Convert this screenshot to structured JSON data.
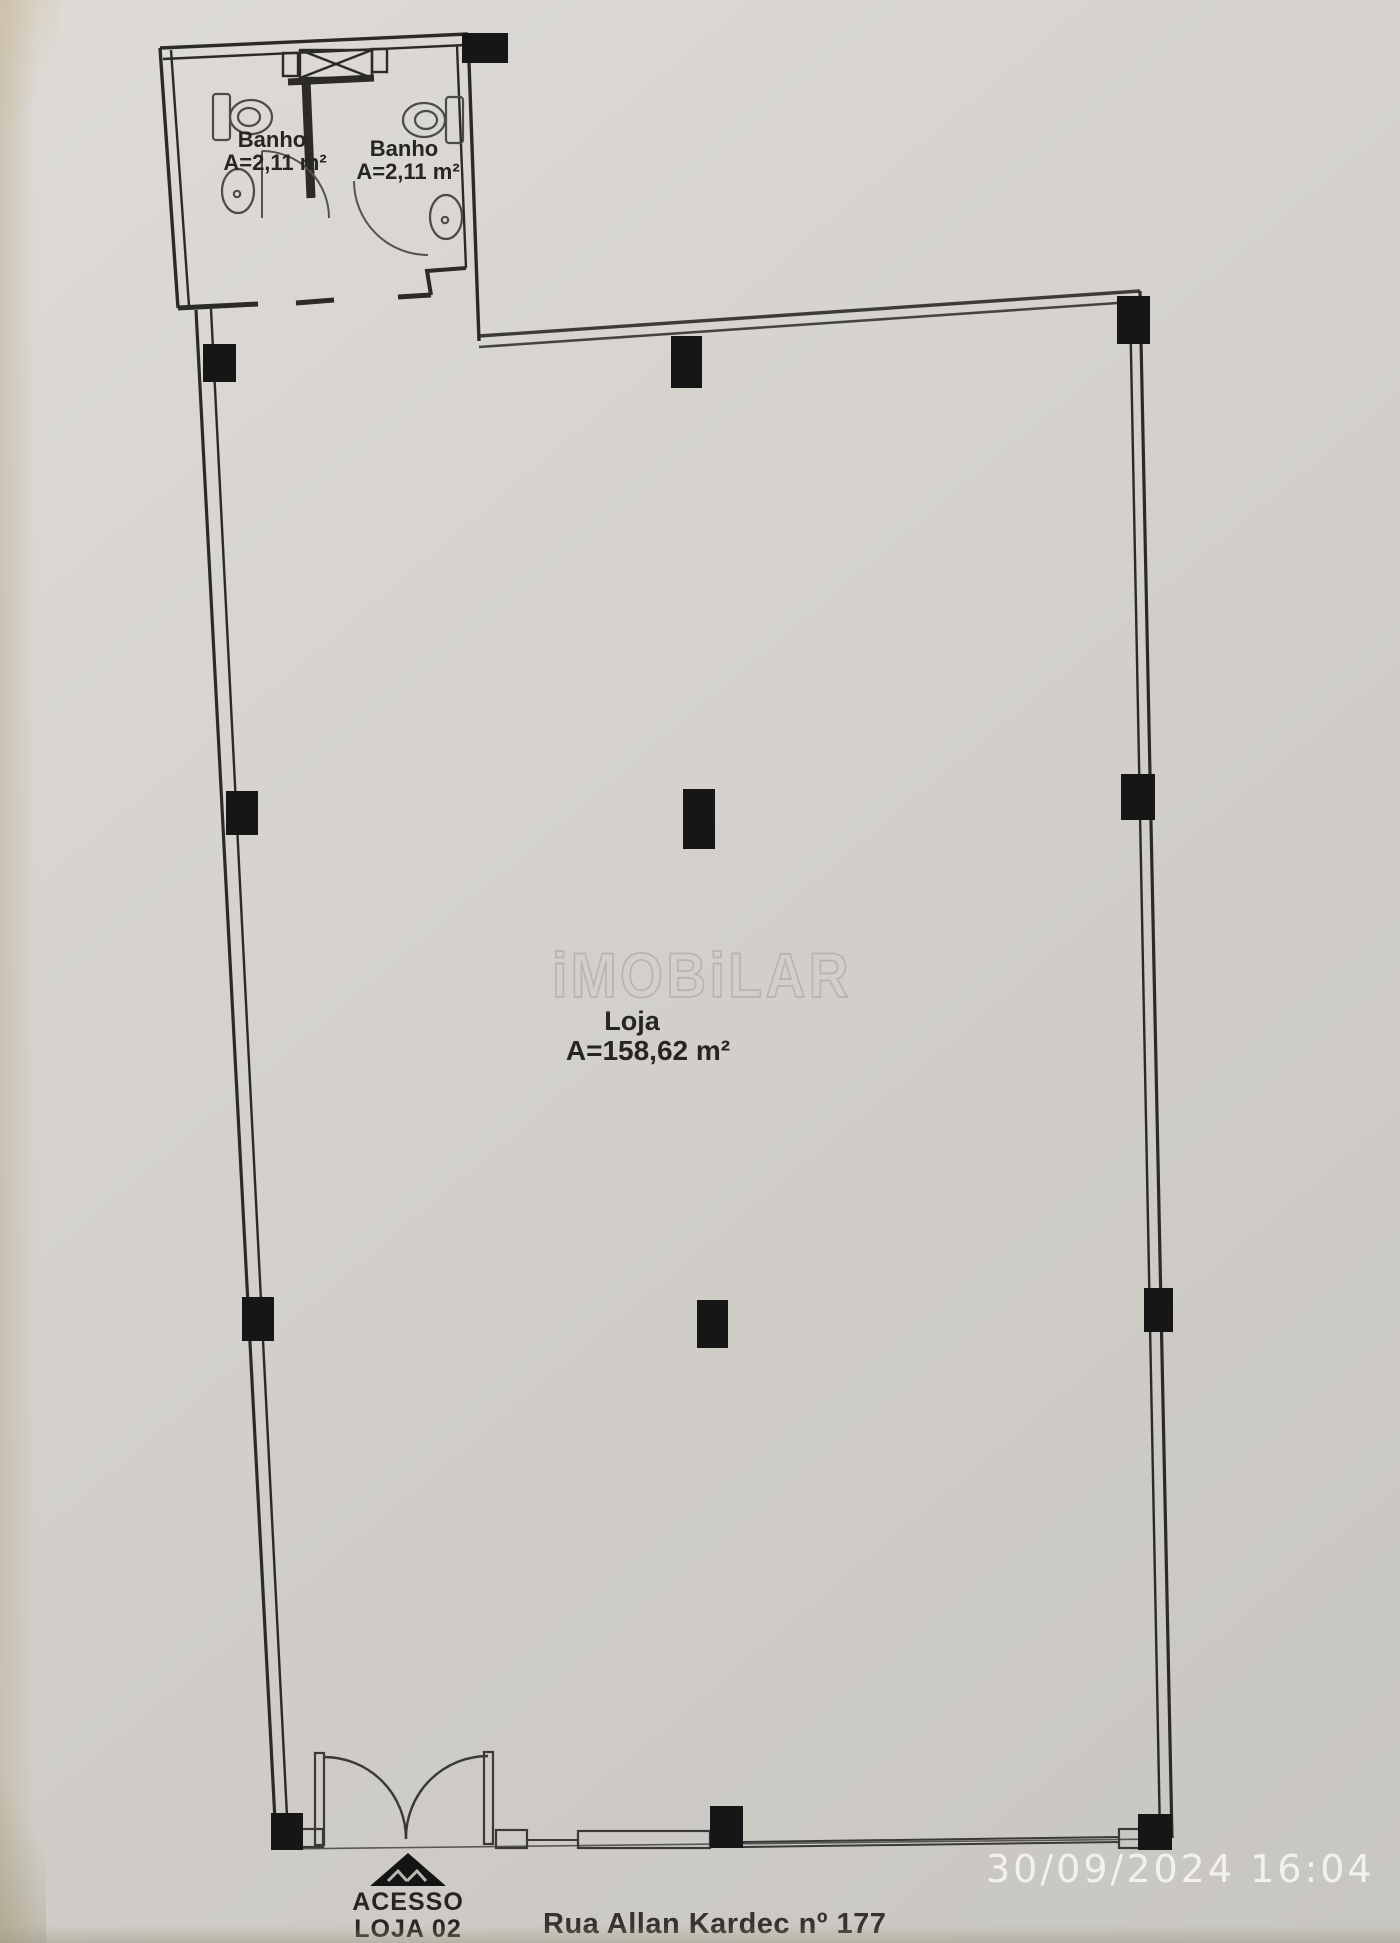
{
  "photo": {
    "timestamp": "30/09/2024  16:04"
  },
  "plan": {
    "watermark": "iMOBiLAR",
    "store": {
      "label": "Loja",
      "area": "A=158,62 m²"
    },
    "bathroom_left": {
      "label": "Banho",
      "area": "A=2,11 m²"
    },
    "bathroom_right": {
      "label": "Banho",
      "area": "A=2,11 m²"
    },
    "access": {
      "line1": "ACESSO",
      "line2": "LOJA 02"
    },
    "address": "Rua Allan Kardec nº 177"
  },
  "colors": {
    "ink": "#262626",
    "column_fill": "#161616",
    "fixture": "#4a4a48",
    "paper": "#d4d1cc",
    "timestamp": "#f4f3ef",
    "watermark_stroke": "#b7b3ae"
  }
}
